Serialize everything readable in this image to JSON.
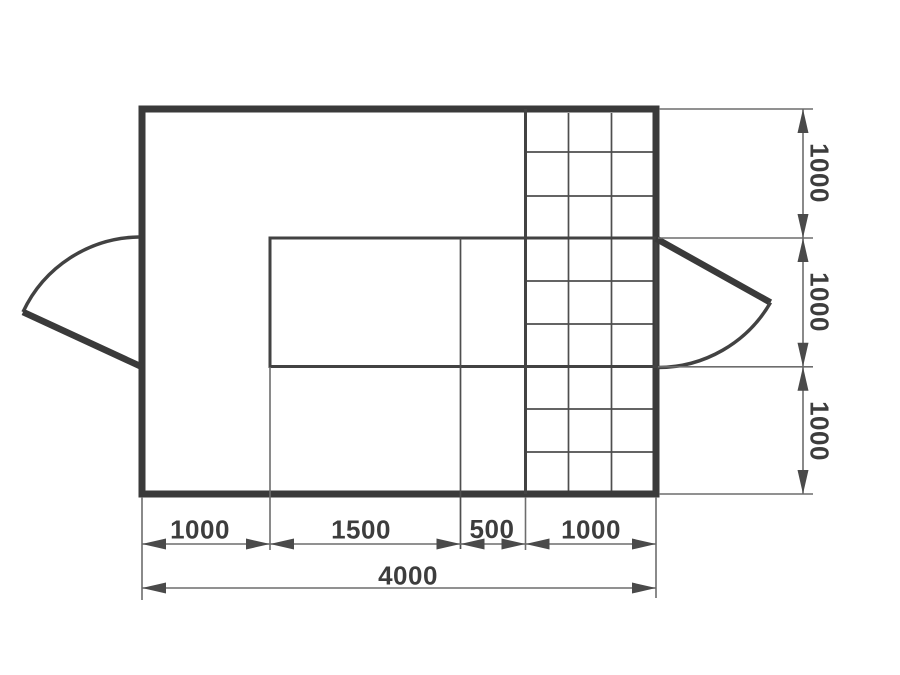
{
  "drawing": {
    "kind": "floor-plan-with-dimensions",
    "dimensions": {
      "bottom_row": [
        "1000",
        "1500",
        "500",
        "1000"
      ],
      "bottom_total": "4000",
      "right_column": [
        "1000",
        "1000",
        "1000"
      ]
    },
    "colors": {
      "background": "#ffffff",
      "wall": "#3a3a3a",
      "line_medium": "#424242",
      "line_thin": "#4e4e4e",
      "dim": "#6d6d6d",
      "arrow": "#4a4a4a",
      "label": "#3d3d3d"
    }
  }
}
